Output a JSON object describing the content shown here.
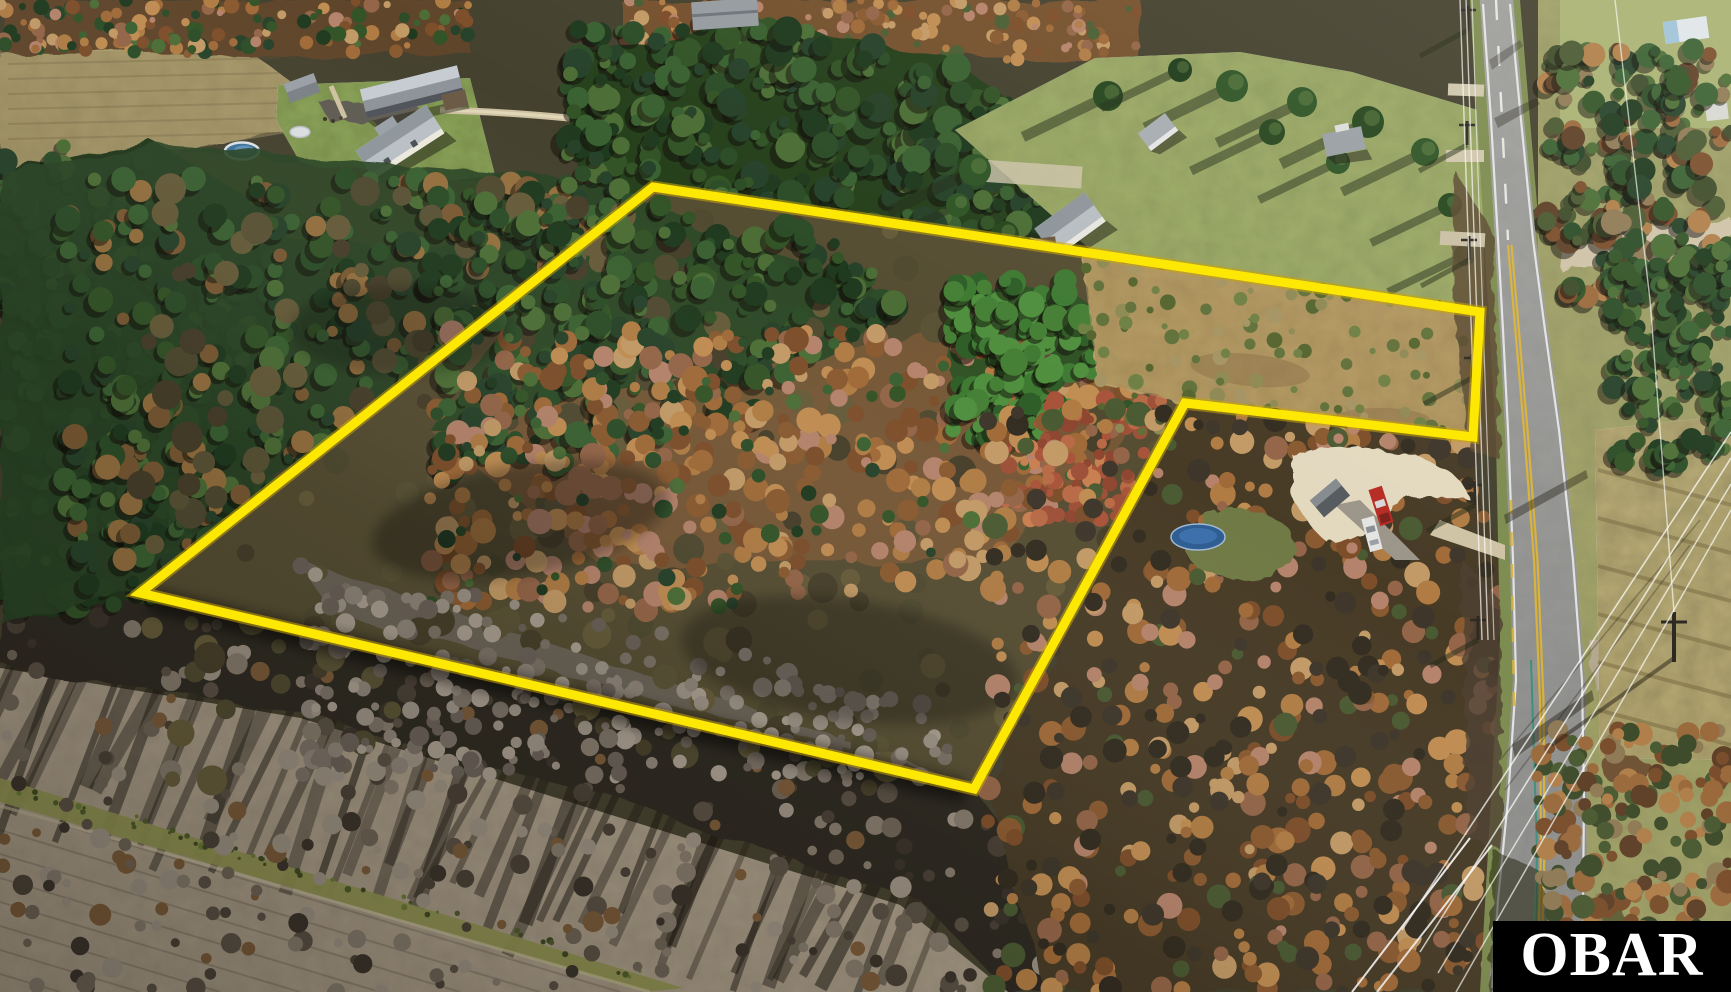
{
  "watermark": {
    "label": "OBAR",
    "background": "#000000",
    "text_color": "#ffffff"
  },
  "boundary_overlay": {
    "points": "653,187 1480,312 1473,437 1185,403 974,789 140,593",
    "stroke_color": "#fce803",
    "glow_color": "#c9a40a",
    "stroke_width": "9"
  },
  "palette": {
    "road_center_line": "#d9b23a",
    "road_edge_line": "#ebebeb",
    "trampoline_blue": "#2e5d92",
    "truck_red": "#b52c24",
    "suv_white": "#e4e4e2",
    "pool_blue": "#3e729b",
    "sand_driveway": "#e3d9bf"
  }
}
